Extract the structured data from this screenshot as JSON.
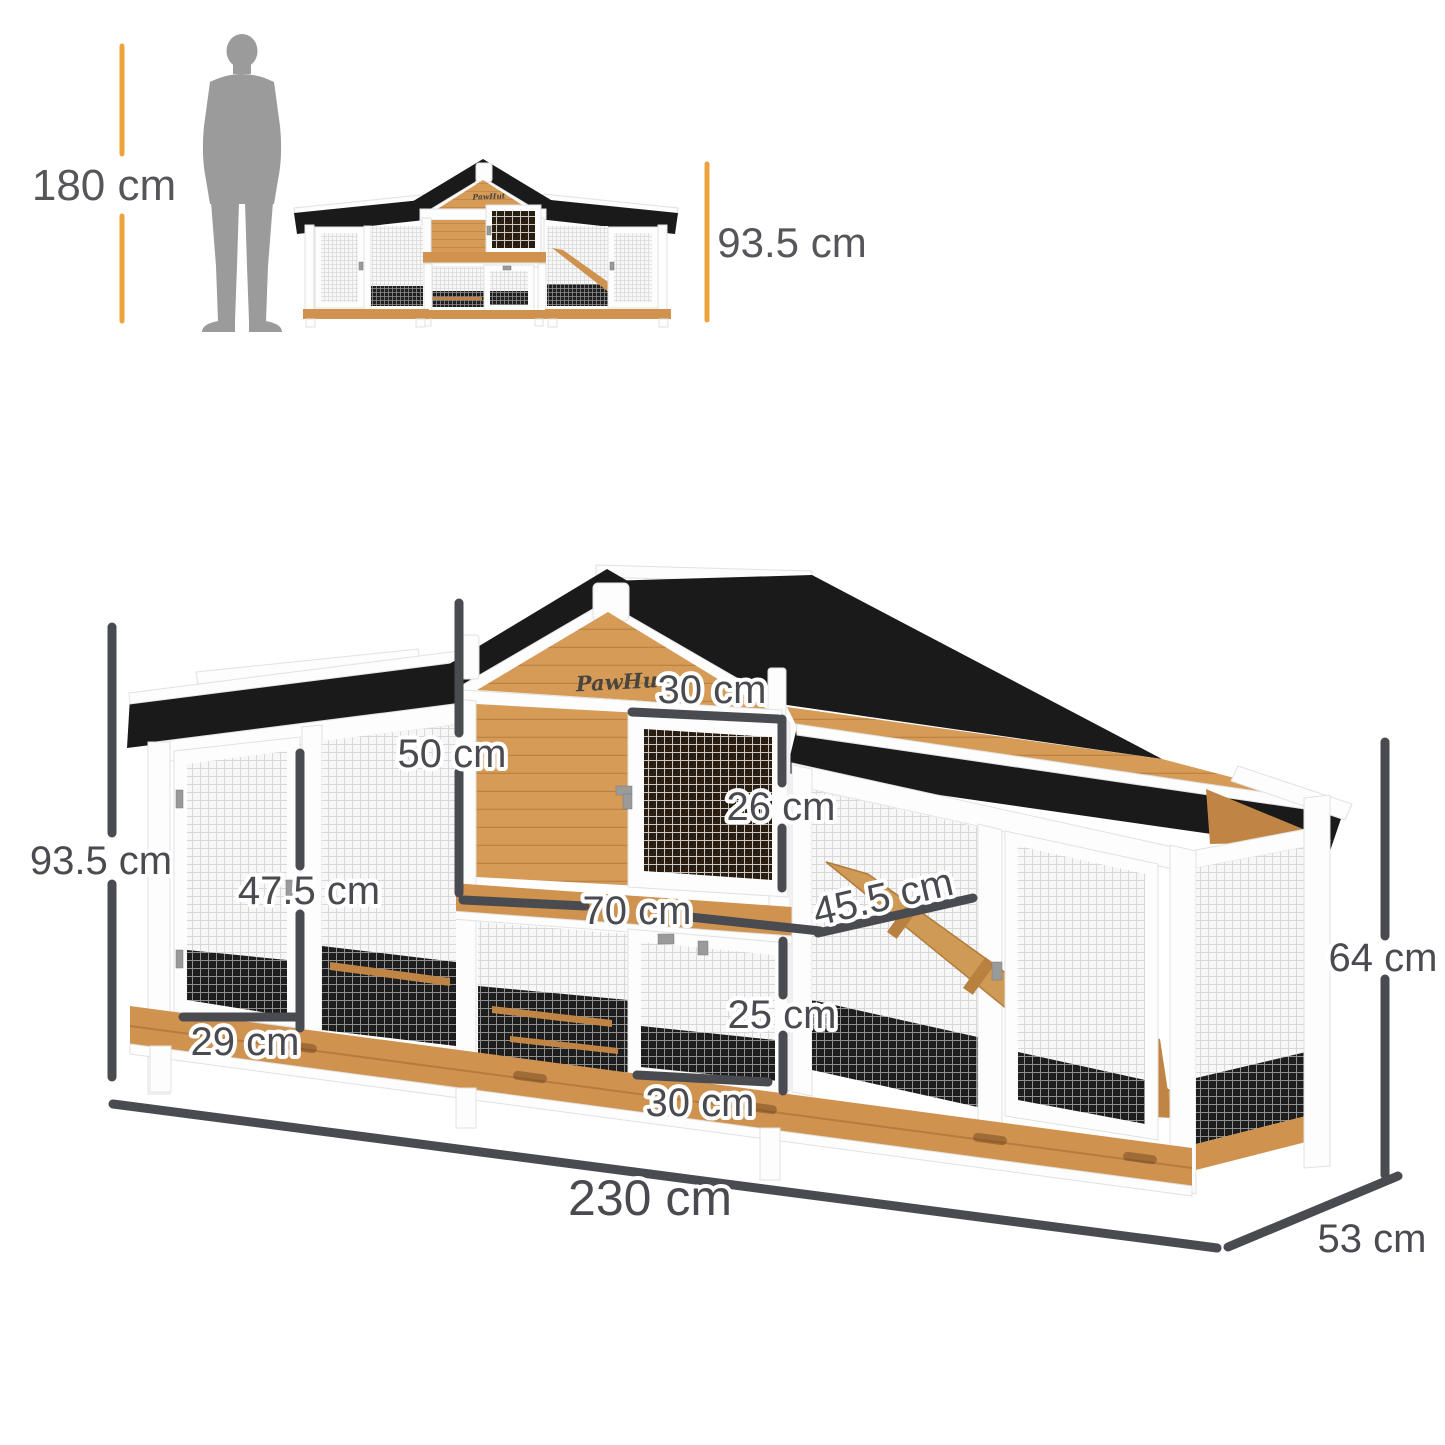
{
  "scale_reference": {
    "person_height": "180 cm",
    "hutch_height": "93.5 cm"
  },
  "brand": {
    "logo_text": "PawHut"
  },
  "dimensions": {
    "total_width": "230 cm",
    "total_depth": "53 cm",
    "total_height": "93.5 cm",
    "run_height": "64 cm",
    "upper_house_width": "70 cm",
    "upper_house_height": "50 cm",
    "upper_door_width": "30 cm",
    "upper_door_height": "26 cm",
    "ramp_length": "45.5 cm",
    "side_door_height": "47.5 cm",
    "side_door_width": "29 cm",
    "lower_door_height": "25 cm",
    "lower_door_width": "30 cm"
  },
  "colors": {
    "accent_yellow": "#ECA33B",
    "dimension_gray": "#4A4B50",
    "roof_black": "#1A1A1A",
    "wood": "#D59B57",
    "frame_white": "#FDFDFD",
    "silhouette_gray": "#9B9B9B"
  }
}
